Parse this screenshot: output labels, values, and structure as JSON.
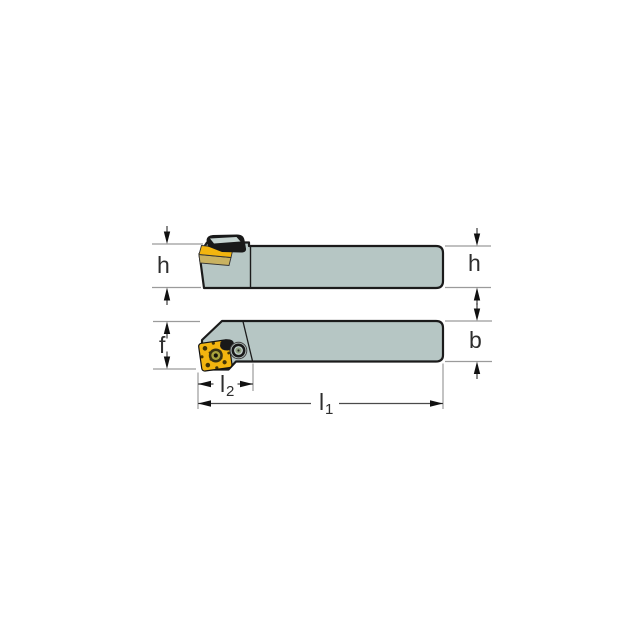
{
  "drawing": {
    "type": "tool-holder-technical-drawing",
    "views": {
      "side_view": "side elevation of tool holder",
      "plan_view": "top plan of tool holder"
    },
    "labels": {
      "h_left": "h",
      "h_right": "h",
      "f": "f",
      "b": "b",
      "l2": {
        "main": "l",
        "sub": "2"
      },
      "l1": {
        "main": "l",
        "sub": "1"
      }
    },
    "colors": {
      "background": "#ffffff",
      "body": "#b6c6c4",
      "body_highlight": "#c6d4d1",
      "outline": "#1b1b1b",
      "insert": "#f3b50f",
      "insert_face": "#c9b261",
      "insert_texture": "#2b2405",
      "clamp": "#191919",
      "screw_boss": "#c3d1ce",
      "screw_ring": "#1a1a1a",
      "screw_center": "#8fa080",
      "screw_dot": "#222222",
      "hole_outer": "#3a3413",
      "hole_mid": "#a8a43c",
      "hole_core": "#16130a",
      "ext_line": "#9b9b9b",
      "dim_line": "#4a4a4a",
      "arrow": "#111111",
      "label": "#2e2e2e"
    }
  }
}
